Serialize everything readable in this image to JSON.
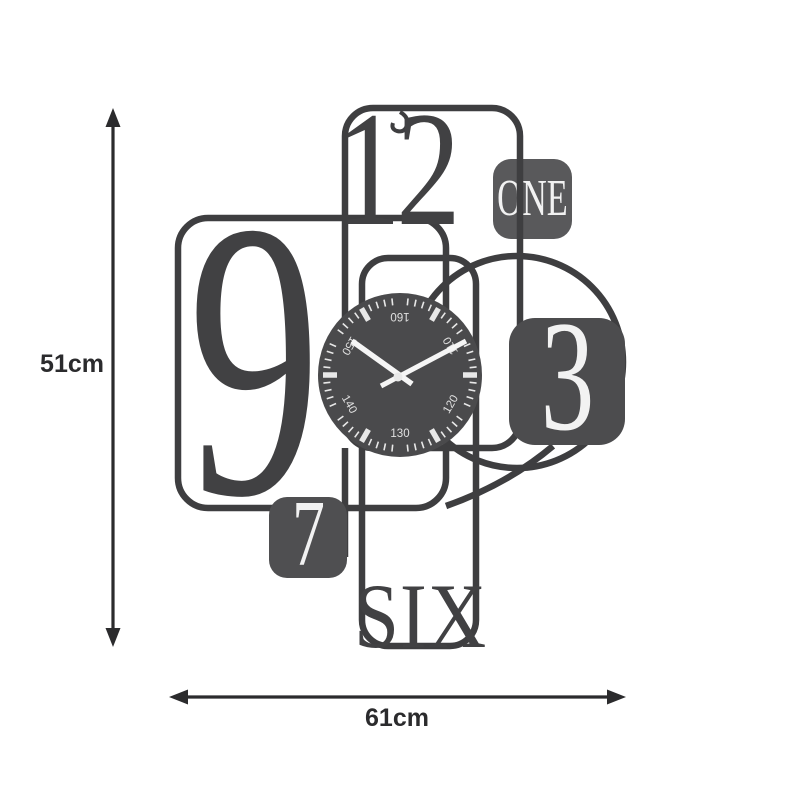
{
  "product": {
    "description": "metal wall clock dimension diagram"
  },
  "dimensions": {
    "height_label": "51cm",
    "width_label": "61cm"
  },
  "clock": {
    "numerals": {
      "twelve": "12",
      "nine": "9",
      "one": "ONE",
      "three": "3",
      "seven": "7",
      "six": "SIX"
    },
    "dial_numbers": [
      {
        "label": "160",
        "position_deg": 0
      },
      {
        "label": "150",
        "position_deg": 300
      },
      {
        "label": "140",
        "position_deg": 240
      },
      {
        "label": "130",
        "position_deg": 180
      },
      {
        "label": "120",
        "position_deg": 120
      },
      {
        "label": "110",
        "position_deg": 60
      }
    ],
    "colors": {
      "wire": "#3e3e40",
      "dial": "#4a4a4c",
      "square_one": "#59595b",
      "square_three": "#4c4c4e",
      "square_seven": "#4f4f51",
      "numeral_dark": "#414143",
      "white_text": "#f2f2f2",
      "tick": "#e8e8e8",
      "hands": "#f5f5f5",
      "dimension_arrow": "#2b2b2d",
      "background": "#ffffff"
    }
  }
}
